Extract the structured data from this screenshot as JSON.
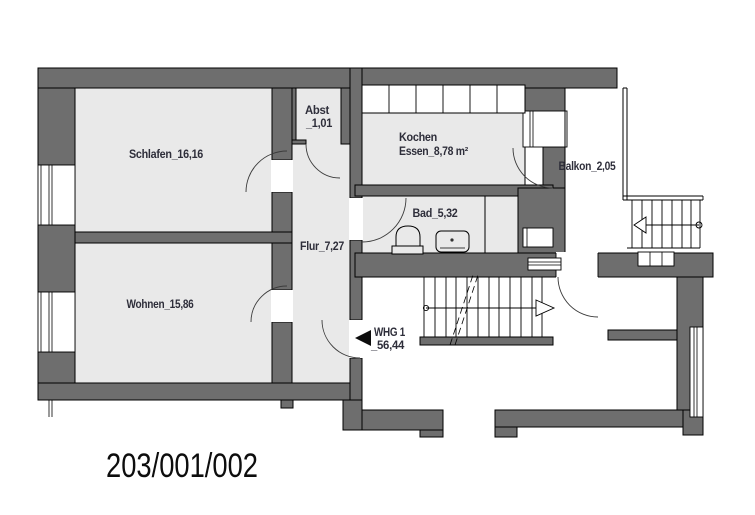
{
  "plan": {
    "plan_number": "203/001/002",
    "apartment": {
      "name": "WHG 1",
      "area": "_56,44"
    },
    "rooms": [
      {
        "id": "schlafen",
        "label": "Schlafen_16,16"
      },
      {
        "id": "wohnen",
        "label": "Wohnen_15,86"
      },
      {
        "id": "abst",
        "label": "Abst",
        "area": "_1,01"
      },
      {
        "id": "flur",
        "label": "Flur_7,27"
      },
      {
        "id": "kochen",
        "label": "Kochen",
        "area": "Essen_8,78 m²"
      },
      {
        "id": "bad",
        "label": "Bad_5,32"
      },
      {
        "id": "balkon",
        "label": "Balkon_2,05"
      }
    ],
    "icons": [
      "entrance-arrow-icon",
      "stair-direction-arrow-icon",
      "stair-start-circle-icon"
    ],
    "colors": {
      "wall": "#6e6e6e",
      "room_fill": "#e9e9e9",
      "line": "#000000",
      "label": "#2e2e3a",
      "plan_number": "#0d0d0d",
      "background": "#ffffff"
    }
  }
}
